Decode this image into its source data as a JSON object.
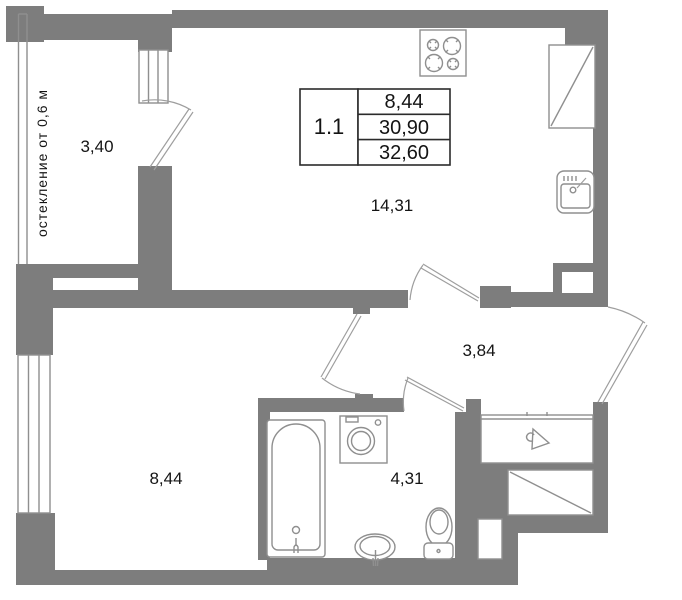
{
  "floor_plan": {
    "glazing_note": "остекление от 0,6 м",
    "info_table": {
      "apartment_number": "1.1",
      "values": [
        "8,44",
        "30,90",
        "32,60"
      ]
    },
    "rooms": {
      "balcony": "3,40",
      "kitchen_living": "14,31",
      "hall": "3,84",
      "room": "8,44",
      "bathroom": "4,31"
    },
    "colors": {
      "wall": "#7d7d7d",
      "outline": "#8f8f8f",
      "table_border": "#2b2b2b",
      "text": "#141414",
      "background": "#ffffff"
    }
  }
}
